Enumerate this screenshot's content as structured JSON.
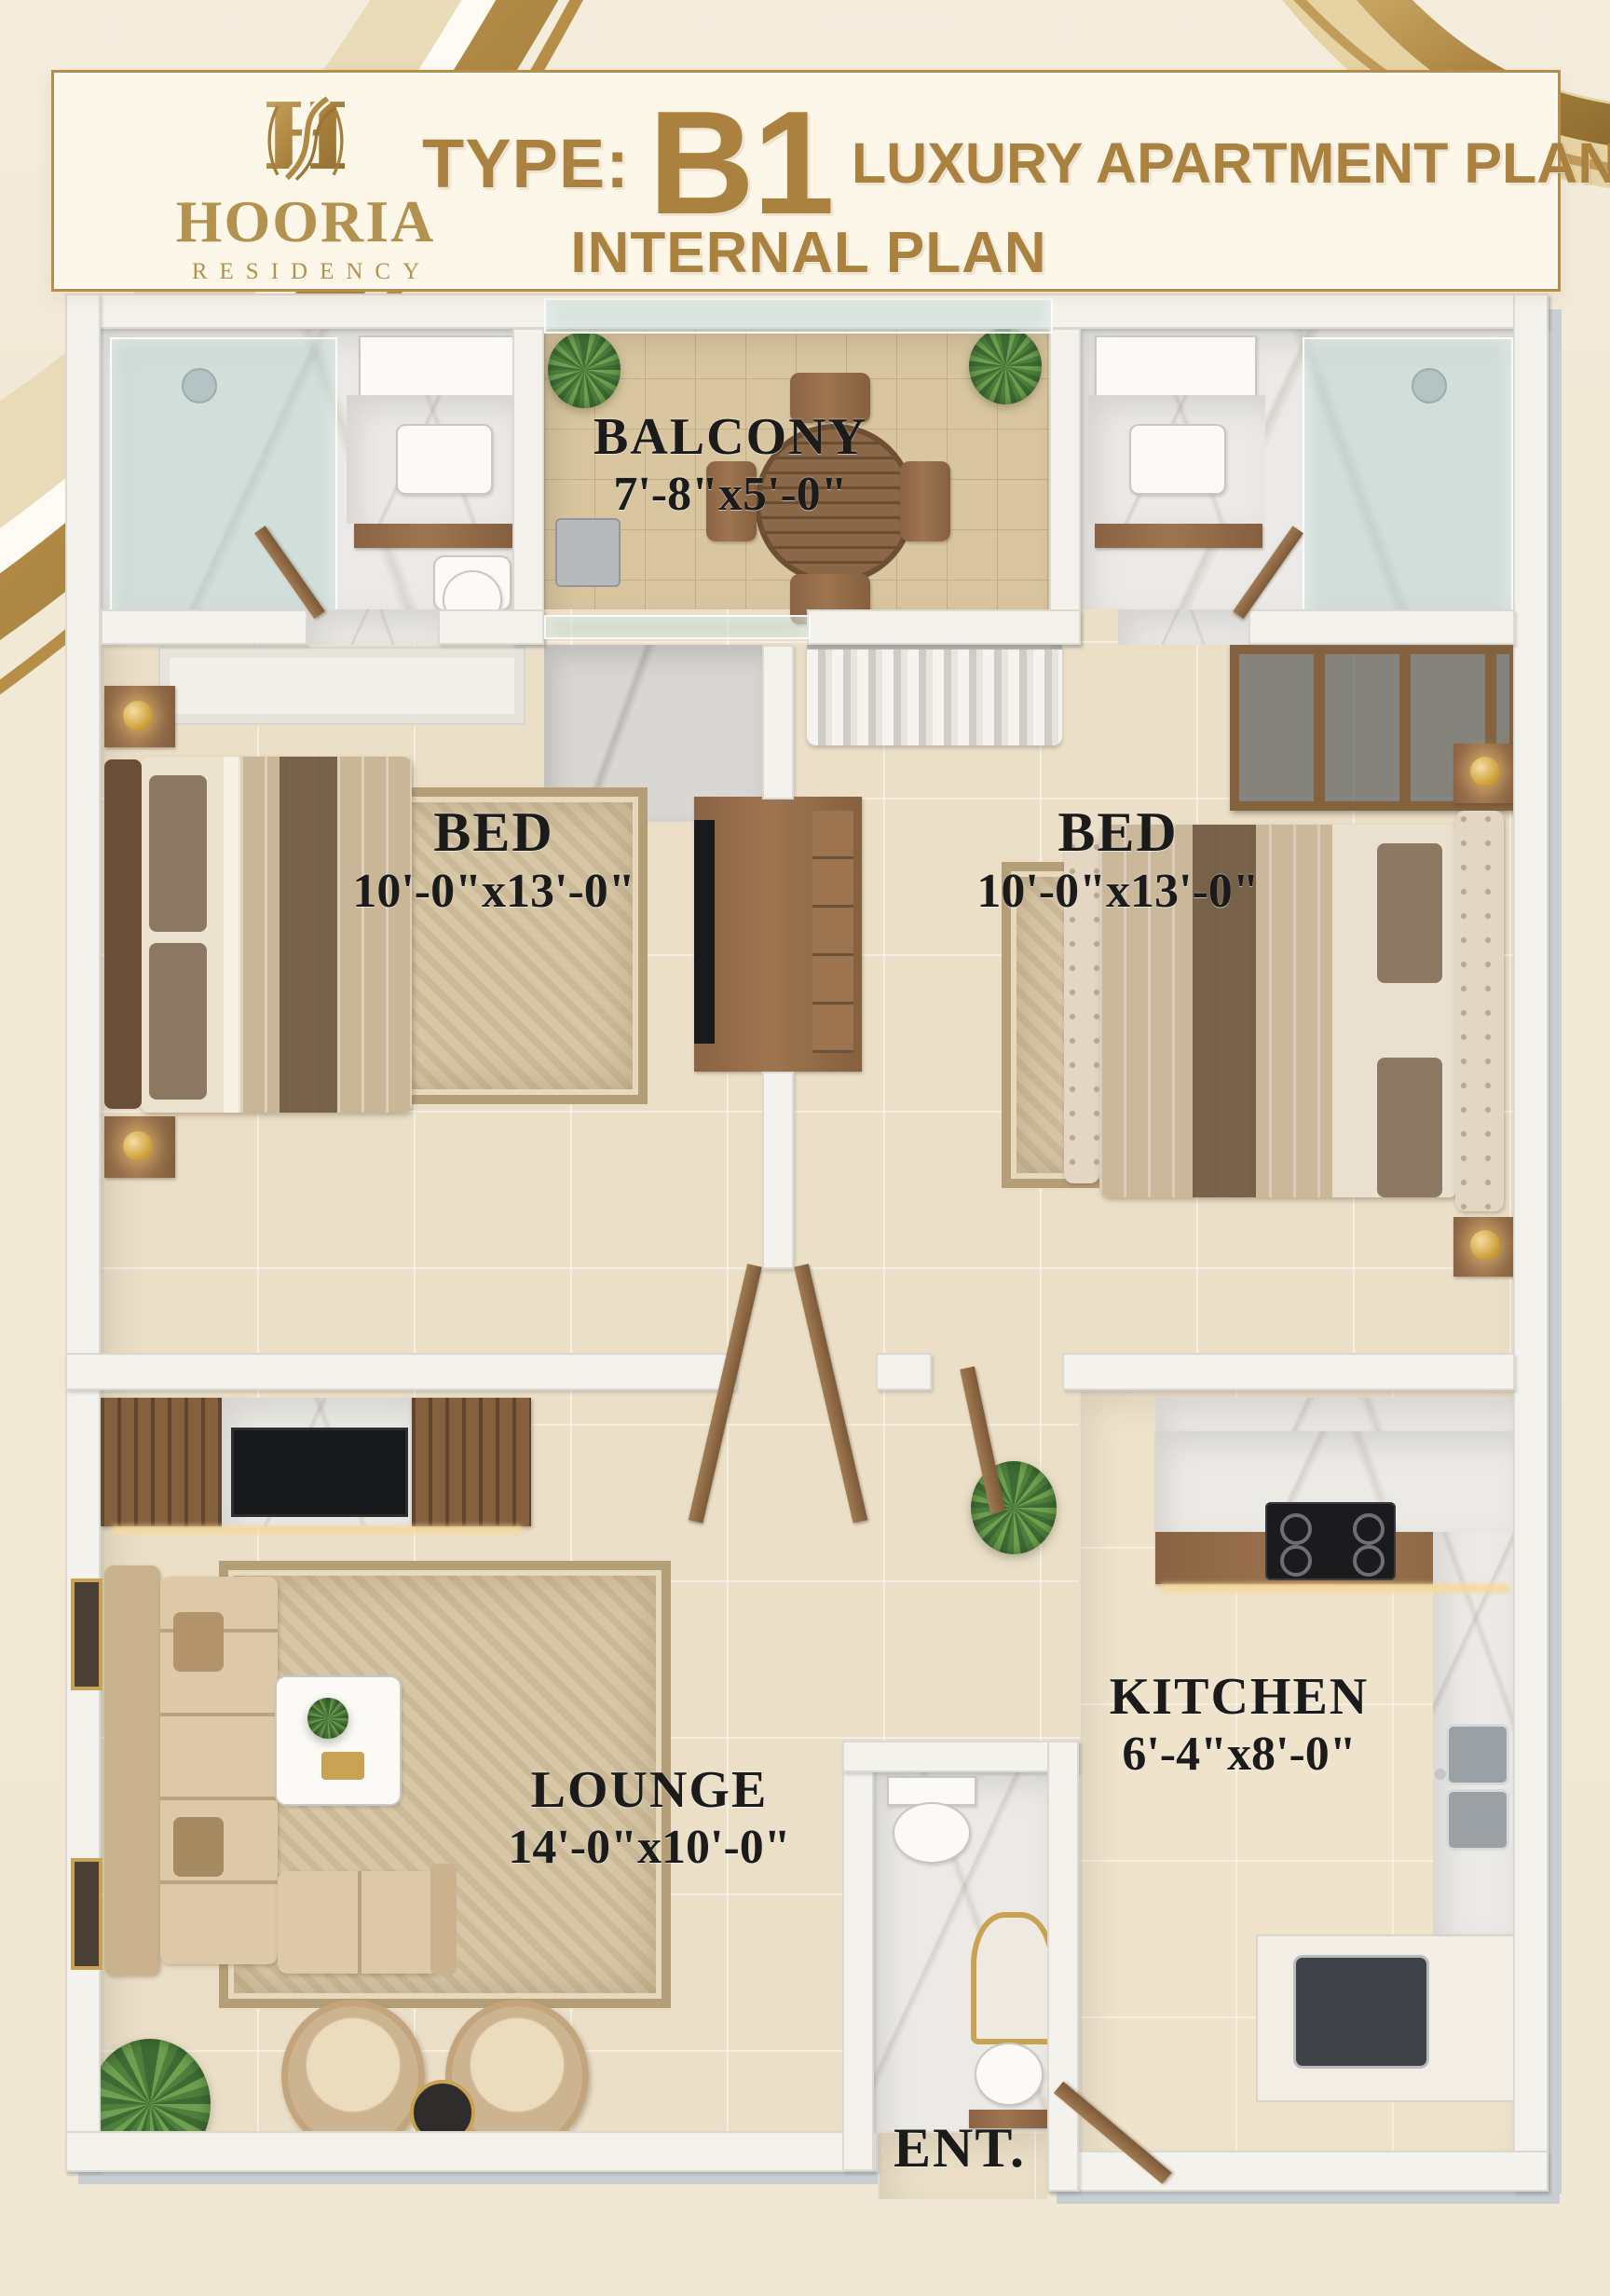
{
  "header": {
    "brand": {
      "monogram": "H",
      "name": "HOORIA",
      "tagline": "RESIDENCY"
    },
    "title": {
      "prefix": "TYPE:",
      "code": "B1",
      "suffix": "LUXURY APARTMENT PLAN",
      "subtitle": "INTERNAL PLAN"
    }
  },
  "floor_plan": {
    "rooms": {
      "balcony": {
        "label": "BALCONY",
        "dimensions": "7'-8\"x5'-0\""
      },
      "bedroom_left": {
        "label": "BED",
        "dimensions": "10'-0\"x13'-0\""
      },
      "bedroom_right": {
        "label": "BED",
        "dimensions": "10'-0\"x13'-0\""
      },
      "lounge": {
        "label": "LOUNGE",
        "dimensions": "14'-0\"x10'-0\""
      },
      "kitchen": {
        "label": "KITCHEN",
        "dimensions": "6'-4\"x8'-0\""
      },
      "entrance": {
        "label": "ENT."
      }
    }
  },
  "colors": {
    "gold_accent": "#b08a45",
    "label_ink": "#1b1b1b",
    "background_cream": "#f2e8d6",
    "wall_white": "#f4f2ec",
    "wood_brown": "#8a6344"
  }
}
